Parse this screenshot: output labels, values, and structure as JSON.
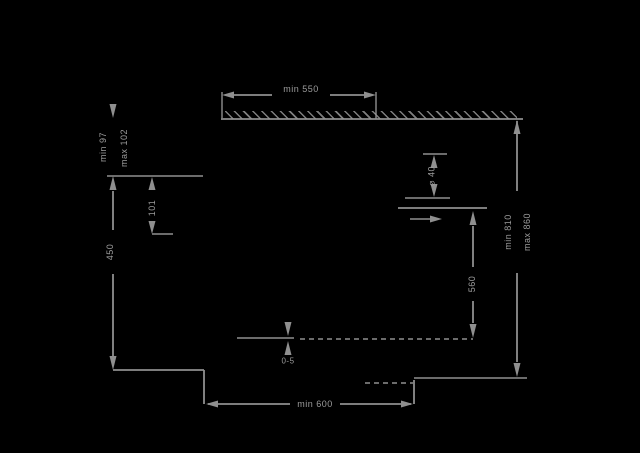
{
  "drawing": {
    "background": "#000000",
    "line_color": "#8f8f8f",
    "text_color": "#9c9c9c",
    "dimensions": {
      "top_width": "min 550",
      "upper_left_min": "min 97",
      "upper_left_max": "max 102",
      "upper_offset": "101",
      "left_height": "450",
      "hole_diameter": "⌀ 40",
      "inner_depth": "560",
      "right_height_min": "min 810",
      "right_height_max": "max 860",
      "bottom_width": "min 600",
      "floor_gap": "0-5"
    }
  }
}
